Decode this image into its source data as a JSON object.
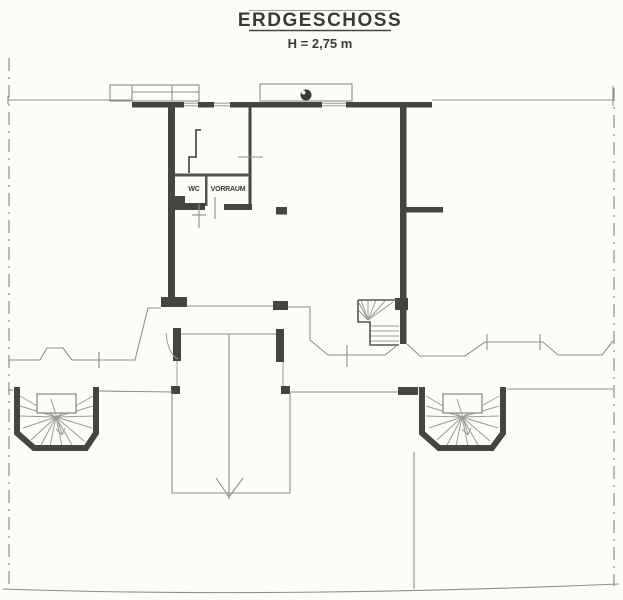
{
  "drawing": {
    "title": "ERDGESCHOSS",
    "height_note": "H = 2,75 m",
    "type": "architectural floor plan, ground floor, scanned line drawing"
  },
  "rooms": {
    "wc_label": "WC",
    "vorraum_label": "VORRAUM"
  },
  "symbols": {
    "down_arrow": "entrance/direction arrow pointing down on terrace axis",
    "ball_symbol": "filled circle symbol on upper bay outline",
    "stairs": [
      "interior winder stair",
      "left exterior fan stair",
      "right exterior fan stair"
    ]
  },
  "colors": {
    "paper": "#fcfcf9",
    "wall": "#45453e",
    "thin_line": "#8f8f88",
    "text": "#3a3a34"
  }
}
